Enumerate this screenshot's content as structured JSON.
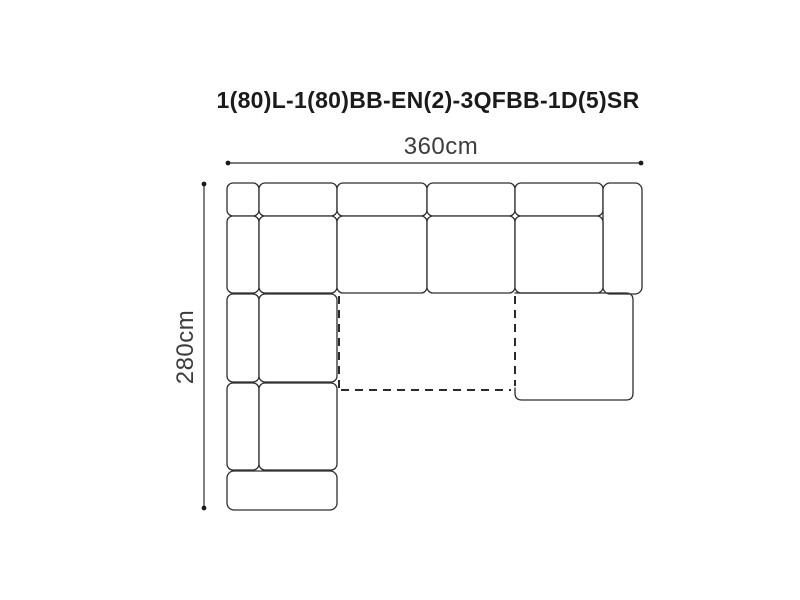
{
  "title": "1(80)L-1(80)BB-EN(2)-3QFBB-1D(5)SR",
  "dimensions": {
    "width_label": "360cm",
    "height_label": "280cm"
  },
  "colors": {
    "background": "#ffffff",
    "piece_line": "#2e2e2e",
    "piece_fill": "#ffffff",
    "dashed_line": "#2a2a2a",
    "dimension_line": "#2e2e2e",
    "dimension_dot": "#1b1b1b",
    "title_text": "#1b1b1b",
    "dim_text": "#3c3c3c"
  },
  "diagram": {
    "pieces": [
      {
        "name": "corner-back-section",
        "x": 227,
        "y": 183,
        "w": 32,
        "h": 33,
        "rx": 6
      },
      {
        "name": "back-cushion-1",
        "x": 259,
        "y": 183,
        "w": 78,
        "h": 33,
        "rx": 6
      },
      {
        "name": "back-cushion-2",
        "x": 337,
        "y": 183,
        "w": 90,
        "h": 33,
        "rx": 6
      },
      {
        "name": "back-cushion-3",
        "x": 427,
        "y": 183,
        "w": 88,
        "h": 33,
        "rx": 6
      },
      {
        "name": "back-cushion-4",
        "x": 515,
        "y": 183,
        "w": 88,
        "h": 33,
        "rx": 6
      },
      {
        "name": "right-armrest",
        "x": 603,
        "y": 183,
        "w": 39,
        "h": 111,
        "rx": 7
      },
      {
        "name": "left-back-strip-1",
        "x": 227,
        "y": 216,
        "w": 32,
        "h": 77,
        "rx": 6
      },
      {
        "name": "corner-seat",
        "x": 259,
        "y": 216,
        "w": 78,
        "h": 77,
        "rx": 6
      },
      {
        "name": "seat-cushion-2",
        "x": 337,
        "y": 216,
        "w": 90,
        "h": 77,
        "rx": 6
      },
      {
        "name": "seat-cushion-3",
        "x": 427,
        "y": 216,
        "w": 88,
        "h": 77,
        "rx": 6
      },
      {
        "name": "seat-cushion-4",
        "x": 515,
        "y": 216,
        "w": 88,
        "h": 77,
        "rx": 6
      },
      {
        "name": "left-back-strip-2",
        "x": 227,
        "y": 294,
        "w": 32,
        "h": 88,
        "rx": 6
      },
      {
        "name": "left-seat-cushion-2",
        "x": 259,
        "y": 294,
        "w": 78,
        "h": 88,
        "rx": 6
      },
      {
        "name": "left-back-strip-3",
        "x": 227,
        "y": 383,
        "w": 32,
        "h": 87,
        "rx": 6
      },
      {
        "name": "left-seat-cushion-3",
        "x": 259,
        "y": 383,
        "w": 78,
        "h": 87,
        "rx": 6
      },
      {
        "name": "bottom-armrest",
        "x": 227,
        "y": 471,
        "w": 110,
        "h": 39,
        "rx": 7
      },
      {
        "name": "chaise-extension",
        "d": "M 515 293 H 626 Q 633 293 633 300 V 393 Q 633 400 626 400 H 522 Q 515 400 515 393 V 388"
      }
    ],
    "dashed_lines": [
      {
        "x1": 339,
        "y1": 296,
        "x2": 339,
        "y2": 388
      },
      {
        "x1": 515,
        "y1": 296,
        "x2": 515,
        "y2": 386
      },
      {
        "x1": 341,
        "y1": 390,
        "x2": 511,
        "y2": 390
      }
    ],
    "dimension_lines": {
      "horizontal": {
        "x1": 228,
        "y": 163,
        "x2": 641
      },
      "vertical": {
        "x": 204,
        "y1": 184,
        "y2": 508
      },
      "dot_radius": 2.4
    }
  }
}
